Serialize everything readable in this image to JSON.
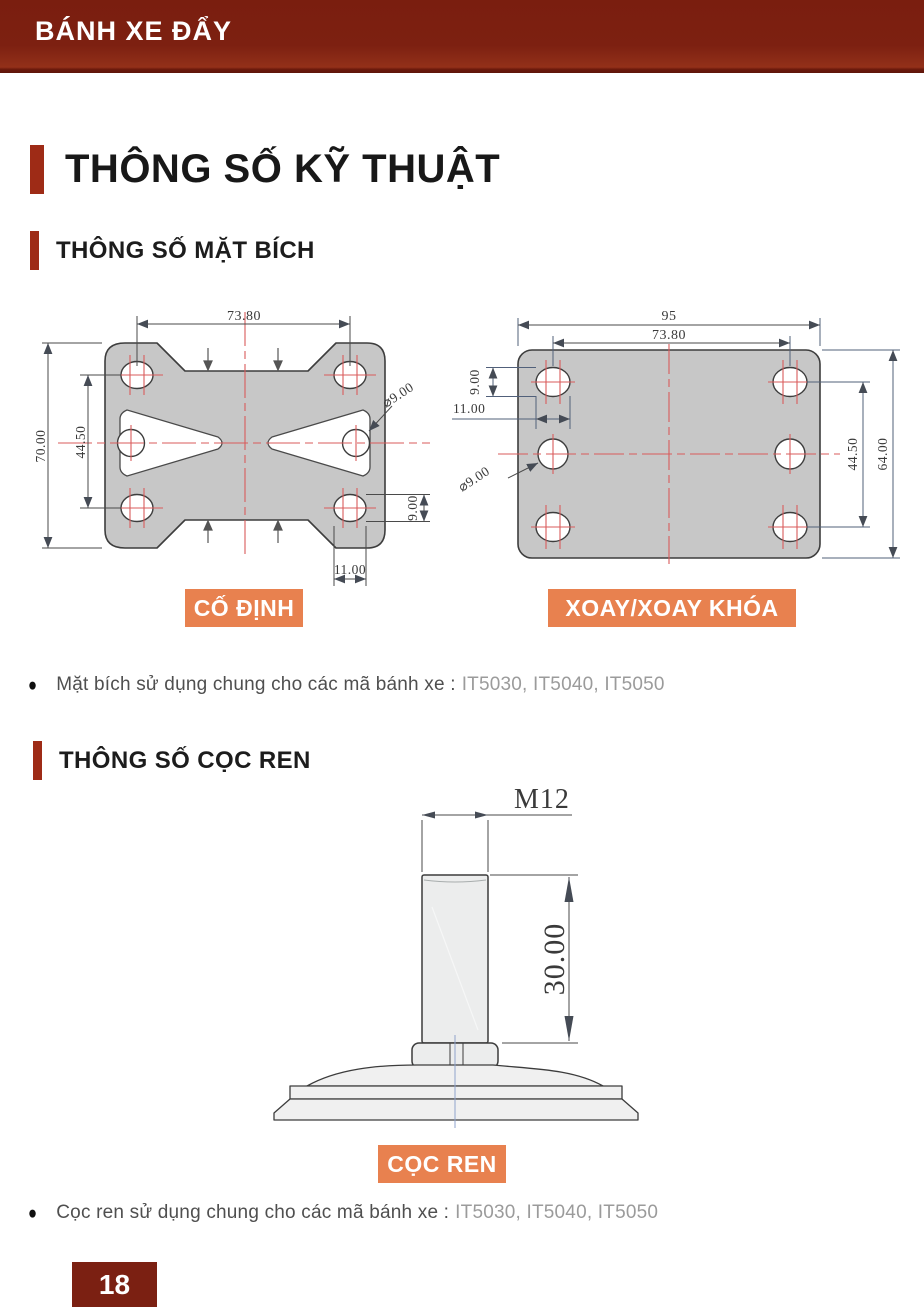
{
  "header": {
    "brand": "BÁNH XE ĐẨY"
  },
  "titles": {
    "main": "THÔNG SỐ KỸ THUẬT",
    "flange": "THÔNG SỐ MẶT BÍCH",
    "stem": "THÔNG SỐ CỌC REN"
  },
  "badges": {
    "fixed": "CỐ ĐỊNH",
    "swivel": "XOAY/XOAY KHÓA",
    "stem": "CỌC REN"
  },
  "notes": {
    "bullet": "●",
    "flange_text": "Mặt bích sử dụng chung cho các mã bánh xe :",
    "flange_codes": "IT5030, IT5040, IT5050",
    "stem_text": "Cọc ren sử dụng chung cho các mã bánh xe :",
    "stem_codes": "IT5030, IT5040, IT5050"
  },
  "fixed_plate_dims": {
    "bolt_span_x": "73.80",
    "plate_height": "70.00",
    "bolt_span_y": "44.50",
    "hole_dia": "⌀9.00",
    "slot_height": "9.00",
    "slot_width": "11.00"
  },
  "swivel_plate_dims": {
    "plate_width": "95",
    "bolt_span_x": "73.80",
    "slot_height": "9.00",
    "slot_width": "11.00",
    "hole_dia": "⌀9.00",
    "bolt_span_y": "44.50",
    "plate_height": "64.00"
  },
  "stem_dims": {
    "thread": "M12",
    "length": "30.00"
  },
  "footer": {
    "page_number": "18"
  },
  "colors": {
    "brand_red": "#7b2012",
    "accent_bar": "#9e2b16",
    "badge_orange": "#e8814f"
  }
}
